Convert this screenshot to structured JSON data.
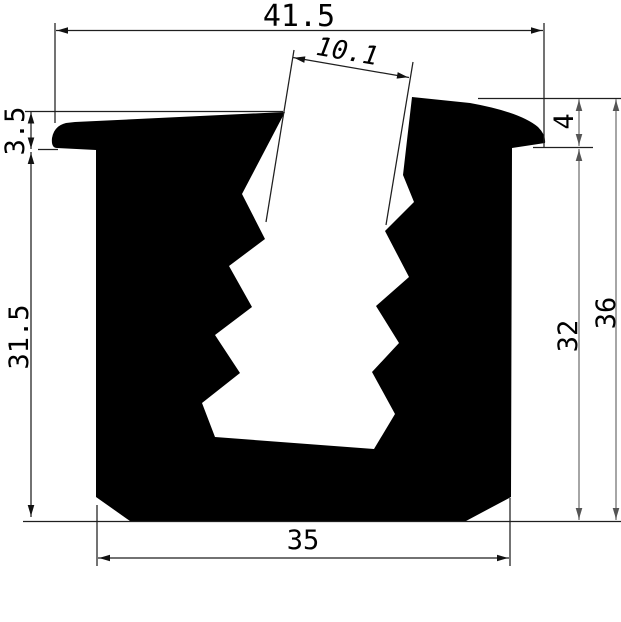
{
  "meta": {
    "type": "technical-profile-drawing",
    "canvas": {
      "width": 621,
      "height": 622
    },
    "colors": {
      "background": "#ffffff",
      "profile_fill": "#000000",
      "dim_dark": "#1f1f1f",
      "dim_gray": "#8f8f8f",
      "arrow_dark": "#111111",
      "arrow_gray": "#555555"
    }
  },
  "measurements": {
    "top_width": "41.5",
    "slot_width": "10.1",
    "left_lip_thickness": "3.5",
    "left_side_height": "31.5",
    "right_lip_height": "4",
    "right_inner_height": "32",
    "overall_height": "36",
    "base_width": "35"
  },
  "drawing": {
    "profile": {
      "name": "u-channel-gasket-profile",
      "path": "M 75,122 L 285,112 L 242,194 L 265,239 L 229,266 L 252,307 L 215,335 L 240,373 L 202,403 L 215,437 L 374,449 L 395,414 L 372,372 L 399,343 L 376,306 L 409,277 L 385,231 L 414,202 L 403,175 L 412,97 L 470,103 Q 520,112 538,127 Q 546,135 545,143 L 512,148 L 511,497 L 466,521 L 130,521 L 96,497 L 96,150 L 57,148 Q 51,148 52,138 Q 54,126 66,123 Z"
    },
    "lines": [
      {
        "name": "ext-line-41-5-left",
        "x1": 55,
        "y1": 23,
        "x2": 55,
        "y2": 123,
        "gray": false
      },
      {
        "name": "ext-line-41-5-right",
        "x1": 544,
        "y1": 23,
        "x2": 544,
        "y2": 147,
        "gray": false
      },
      {
        "name": "dim-line-41-5",
        "x1": 56,
        "y1": 30.5,
        "x2": 543,
        "y2": 30.5,
        "gray": false
      },
      {
        "name": "ext-line-10-1-left",
        "x1": 294,
        "y1": 50,
        "x2": 266,
        "y2": 222,
        "gray": false
      },
      {
        "name": "ext-line-10-1-right",
        "x1": 413,
        "y1": 62,
        "x2": 386,
        "y2": 225,
        "gray": false
      },
      {
        "name": "dim-line-10-1",
        "x1": 293,
        "y1": 57.5,
        "x2": 409,
        "y2": 77.5,
        "gray": false
      },
      {
        "name": "ext-line-3-5-top",
        "x1": 25,
        "y1": 111.5,
        "x2": 283,
        "y2": 111.5,
        "gray": false
      },
      {
        "name": "ext-line-3-5-bottom",
        "x1": 38,
        "y1": 149.5,
        "x2": 58,
        "y2": 149.5,
        "gray": false
      },
      {
        "name": "dim-line-3-5",
        "x1": 31,
        "y1": 112,
        "x2": 31,
        "y2": 149,
        "gray": false
      },
      {
        "name": "dim-line-31-5",
        "x1": 31,
        "y1": 152,
        "x2": 31,
        "y2": 517,
        "gray": false
      },
      {
        "name": "ext-line-top-right",
        "x1": 478,
        "y1": 98.5,
        "x2": 621,
        "y2": 98.5,
        "gray": false
      },
      {
        "name": "ext-line-lip-right",
        "x1": 533,
        "y1": 147.5,
        "x2": 593,
        "y2": 147.5,
        "gray": false
      },
      {
        "name": "ext-line-baseline",
        "x1": 23,
        "y1": 521.5,
        "x2": 621,
        "y2": 521.5,
        "gray": false
      },
      {
        "name": "ext-line-35-left",
        "x1": 97,
        "y1": 505,
        "x2": 97,
        "y2": 566,
        "gray": false
      },
      {
        "name": "ext-line-35-right",
        "x1": 510,
        "y1": 498,
        "x2": 510,
        "y2": 566,
        "gray": false
      },
      {
        "name": "dim-line-35",
        "x1": 98,
        "y1": 558,
        "x2": 509,
        "y2": 558,
        "gray": false
      },
      {
        "name": "dim-line-4",
        "x1": 579,
        "y1": 99,
        "x2": 579,
        "y2": 146,
        "gray": true
      },
      {
        "name": "dim-line-32",
        "x1": 579,
        "y1": 149,
        "x2": 579,
        "y2": 520,
        "gray": true
      },
      {
        "name": "dim-line-36",
        "x1": 616,
        "y1": 99,
        "x2": 616,
        "y2": 520,
        "gray": true
      }
    ],
    "arrows": [
      {
        "name": "arrow-41-5-left",
        "x": 57,
        "y": 30.5,
        "angle": 180,
        "gray": false
      },
      {
        "name": "arrow-41-5-right",
        "x": 542,
        "y": 30.5,
        "angle": 0,
        "gray": false
      },
      {
        "name": "arrow-10-1-left",
        "x": 294,
        "y": 57.7,
        "angle": 189.8,
        "gray": false
      },
      {
        "name": "arrow-10-1-right",
        "x": 408,
        "y": 77.3,
        "angle": 9.8,
        "gray": false
      },
      {
        "name": "arrow-3-5-top",
        "x": 31,
        "y": 112.5,
        "angle": -90,
        "gray": false
      },
      {
        "name": "arrow-3-5-bottom",
        "x": 31,
        "y": 148.5,
        "angle": 90,
        "gray": false
      },
      {
        "name": "arrow-31-5-top",
        "x": 31,
        "y": 153,
        "angle": -90,
        "gray": false
      },
      {
        "name": "arrow-31-5-bottom",
        "x": 31,
        "y": 516,
        "angle": 90,
        "gray": false
      },
      {
        "name": "arrow-35-left",
        "x": 99,
        "y": 558,
        "angle": 180,
        "gray": false
      },
      {
        "name": "arrow-35-right",
        "x": 508,
        "y": 558,
        "angle": 0,
        "gray": false
      },
      {
        "name": "arrow-4-top",
        "x": 579,
        "y": 100,
        "angle": -90,
        "gray": true
      },
      {
        "name": "arrow-4-bottom",
        "x": 579,
        "y": 145,
        "angle": 90,
        "gray": true
      },
      {
        "name": "arrow-32-top",
        "x": 579,
        "y": 150,
        "angle": -90,
        "gray": true
      },
      {
        "name": "arrow-32-bottom",
        "x": 579,
        "y": 519,
        "angle": 90,
        "gray": true
      },
      {
        "name": "arrow-36-top",
        "x": 616,
        "y": 100,
        "angle": -90,
        "gray": true
      },
      {
        "name": "arrow-36-bottom",
        "x": 616,
        "y": 519,
        "angle": 90,
        "gray": true
      }
    ],
    "labels": [
      {
        "name": "dim-label-41-5",
        "text": "41.5",
        "x": 299,
        "y": 26,
        "rotate": 0,
        "size": 30,
        "italic": false
      },
      {
        "name": "dim-label-10-1",
        "text": "10.1",
        "x": 346,
        "y": 60,
        "rotate": 9.8,
        "size": 26,
        "italic": true
      },
      {
        "name": "dim-label-3-5",
        "text": "3.5",
        "x": 24,
        "y": 131,
        "rotate": -90,
        "size": 27,
        "italic": false
      },
      {
        "name": "dim-label-31-5",
        "text": "31.5",
        "x": 28,
        "y": 337,
        "rotate": -90,
        "size": 27,
        "italic": false
      },
      {
        "name": "dim-label-4",
        "text": "4",
        "x": 573,
        "y": 121.5,
        "rotate": -90,
        "size": 27,
        "italic": false
      },
      {
        "name": "dim-label-32",
        "text": "32",
        "x": 577,
        "y": 336,
        "rotate": -90,
        "size": 27,
        "italic": false
      },
      {
        "name": "dim-label-36",
        "text": "36",
        "x": 615,
        "y": 313,
        "rotate": -90,
        "size": 27,
        "italic": false
      },
      {
        "name": "dim-label-35",
        "text": "35",
        "x": 303,
        "y": 549,
        "rotate": 0,
        "size": 27,
        "italic": false
      }
    ]
  }
}
